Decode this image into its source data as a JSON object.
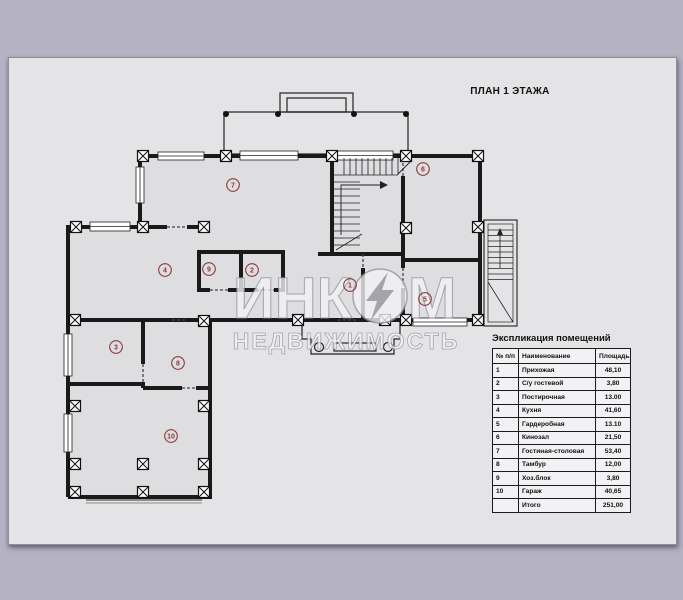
{
  "page": {
    "title": "ПЛАН 1 ЭТАЖА"
  },
  "watermark": {
    "part1": "ИНК",
    "part2": "М",
    "line2": "НЕДВИЖИМОСТЬ",
    "logo": "lightning-in-circle"
  },
  "rooms": [
    {
      "num": "1"
    },
    {
      "num": "2"
    },
    {
      "num": "3"
    },
    {
      "num": "4"
    },
    {
      "num": "5"
    },
    {
      "num": "6"
    },
    {
      "num": "7"
    },
    {
      "num": "8"
    },
    {
      "num": "9"
    },
    {
      "num": "10"
    }
  ],
  "table": {
    "title": "Экспликация помещений",
    "columns": [
      "№ п/п",
      "Наименование",
      "Площадь, м2"
    ],
    "rows": [
      {
        "num": "1",
        "name": "Прихожая",
        "area": "48,10"
      },
      {
        "num": "2",
        "name": "С/у гостевой",
        "area": "3,80"
      },
      {
        "num": "3",
        "name": "Постирочная",
        "area": "13.00"
      },
      {
        "num": "4",
        "name": "Кухня",
        "area": "41,60"
      },
      {
        "num": "5",
        "name": "Гардеробная",
        "area": "13.10"
      },
      {
        "num": "6",
        "name": "Кинозал",
        "area": "21,50"
      },
      {
        "num": "7",
        "name": "Гостиная-столовая",
        "area": "53,40"
      },
      {
        "num": "8",
        "name": "Тамбур",
        "area": "12,00"
      },
      {
        "num": "9",
        "name": "Хоз.блок",
        "area": "3,80"
      },
      {
        "num": "10",
        "name": "Гараж",
        "area": "40,65"
      },
      {
        "num": "",
        "name": "Итого",
        "area": "251,00"
      }
    ]
  },
  "colors": {
    "background": "#b5b3c3",
    "page": "#e4e4e6",
    "wall": "#1a1a1a",
    "room_label": "#8b3a3a",
    "watermark_fill": "#f2f2f4",
    "watermark_outline": "#97959f"
  }
}
